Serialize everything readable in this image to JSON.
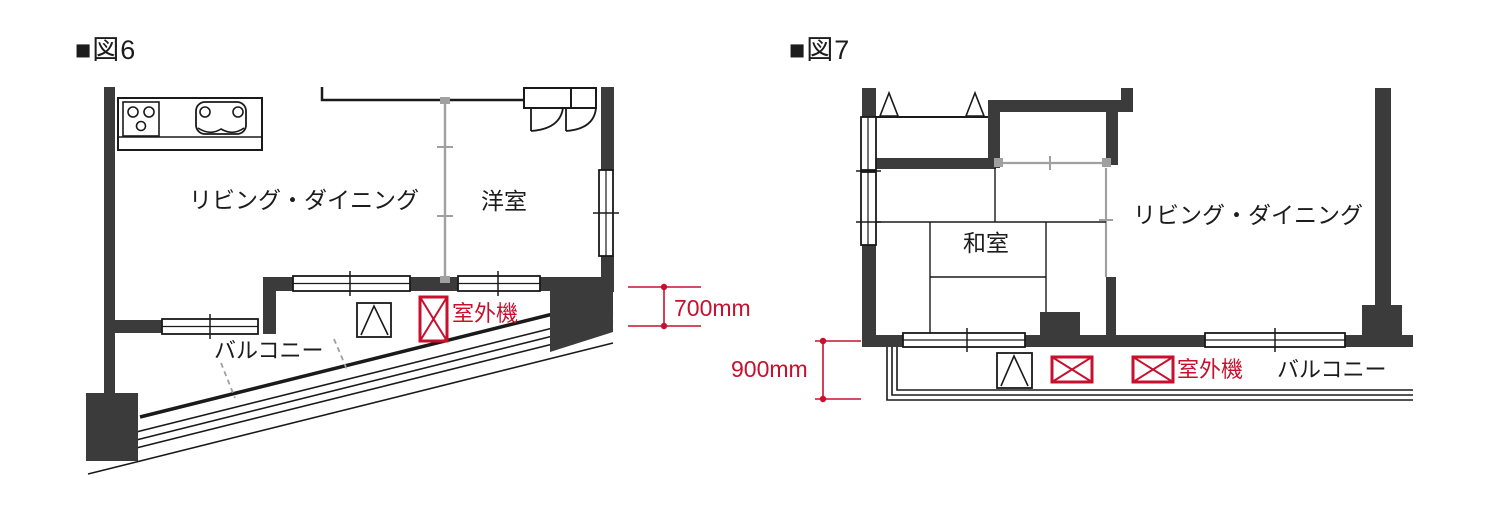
{
  "figure6": {
    "title": "■図6",
    "labels": {
      "living_dining": "リビング・ダイニング",
      "western_room": "洋室",
      "balcony": "バルコニー",
      "outdoor_unit": "室外機",
      "dimension": "700mm"
    }
  },
  "figure7": {
    "title": "■図7",
    "labels": {
      "japanese_room": "和室",
      "living_dining": "リビング・ダイニング",
      "balcony": "バルコニー",
      "outdoor_unit": "室外機",
      "dimension": "900mm"
    }
  },
  "colors": {
    "accent_red": "#c8102e",
    "wall_dark": "#3b3b3b",
    "line_black": "#1a1a1a",
    "partition_gray": "#a0a0a0"
  }
}
